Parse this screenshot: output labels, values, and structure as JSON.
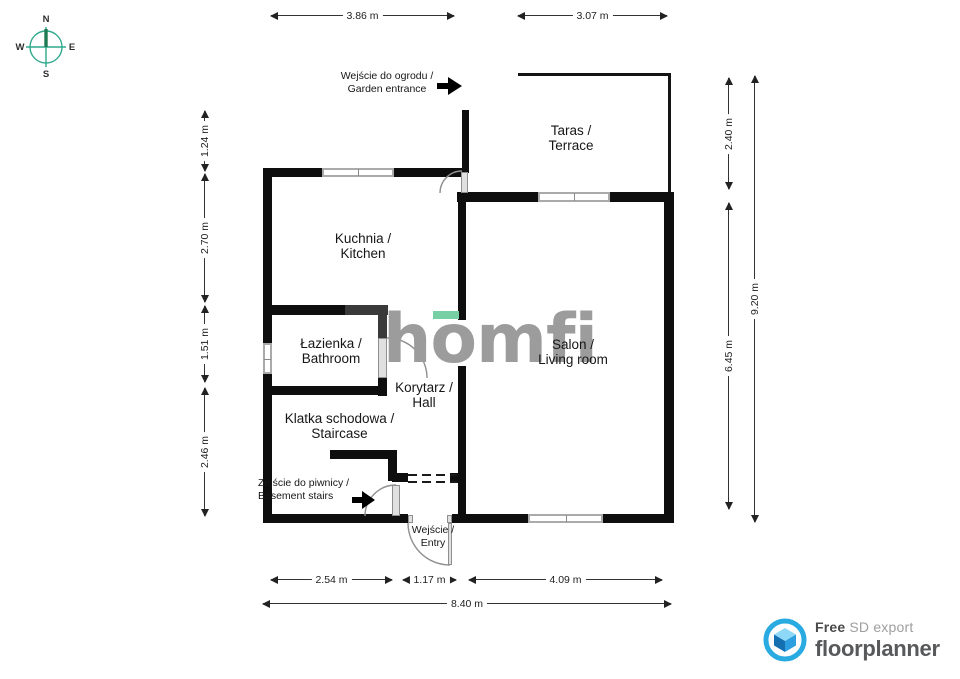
{
  "compass": {
    "n": "N",
    "e": "E",
    "s": "S",
    "w": "W"
  },
  "dimensions": {
    "top": [
      {
        "label": "3.86 m"
      },
      {
        "label": "3.07 m"
      }
    ],
    "left": [
      {
        "label": "1.24 m"
      },
      {
        "label": "2.70 m"
      },
      {
        "label": "1.51 m"
      },
      {
        "label": "2.46 m"
      }
    ],
    "right": [
      {
        "label": "2.40 m"
      },
      {
        "label": "6.45 m"
      },
      {
        "label": "9.20 m"
      }
    ],
    "bottom": [
      {
        "label": "2.54 m"
      },
      {
        "label": "1.17 m"
      },
      {
        "label": "4.09 m"
      },
      {
        "label": "8.40 m"
      }
    ]
  },
  "rooms": {
    "kitchen": {
      "line1": "Kuchnia /",
      "line2": "Kitchen"
    },
    "bathroom": {
      "line1": "Łazienka /",
      "line2": "Bathroom"
    },
    "hall": {
      "line1": "Korytarz /",
      "line2": "Hall"
    },
    "staircase": {
      "line1": "Klatka schodowa /",
      "line2": "Staircase"
    },
    "terrace": {
      "line1": "Taras /",
      "line2": "Terrace"
    },
    "living_room": {
      "line1": "Salon /",
      "line2": "Living room"
    }
  },
  "annotations": {
    "garden": {
      "line1": "Wejście do ogrodu /",
      "line2": "Garden entrance"
    },
    "basement": {
      "line1": "Zejście do piwnicy /",
      "line2": "Basement stairs"
    },
    "entry": {
      "line1": "Wejście /",
      "line2": "Entry"
    }
  },
  "watermark": {
    "text": "homfi",
    "text_color": "#9c9c9c",
    "accent_color": "#76d0a3"
  },
  "footer": {
    "free": "Free",
    "sd_export": "SD export",
    "brand": "floorplanner",
    "brand_blue": "#29abe2"
  },
  "colors": {
    "wall": "#0e0e0e",
    "dark_wall": "#3a3a3a",
    "window_gray": "#aaaaaa",
    "door_gray": "#8f8f8f",
    "compass_teal": "#2fa98c",
    "compass_needle": "#1f7a52"
  }
}
